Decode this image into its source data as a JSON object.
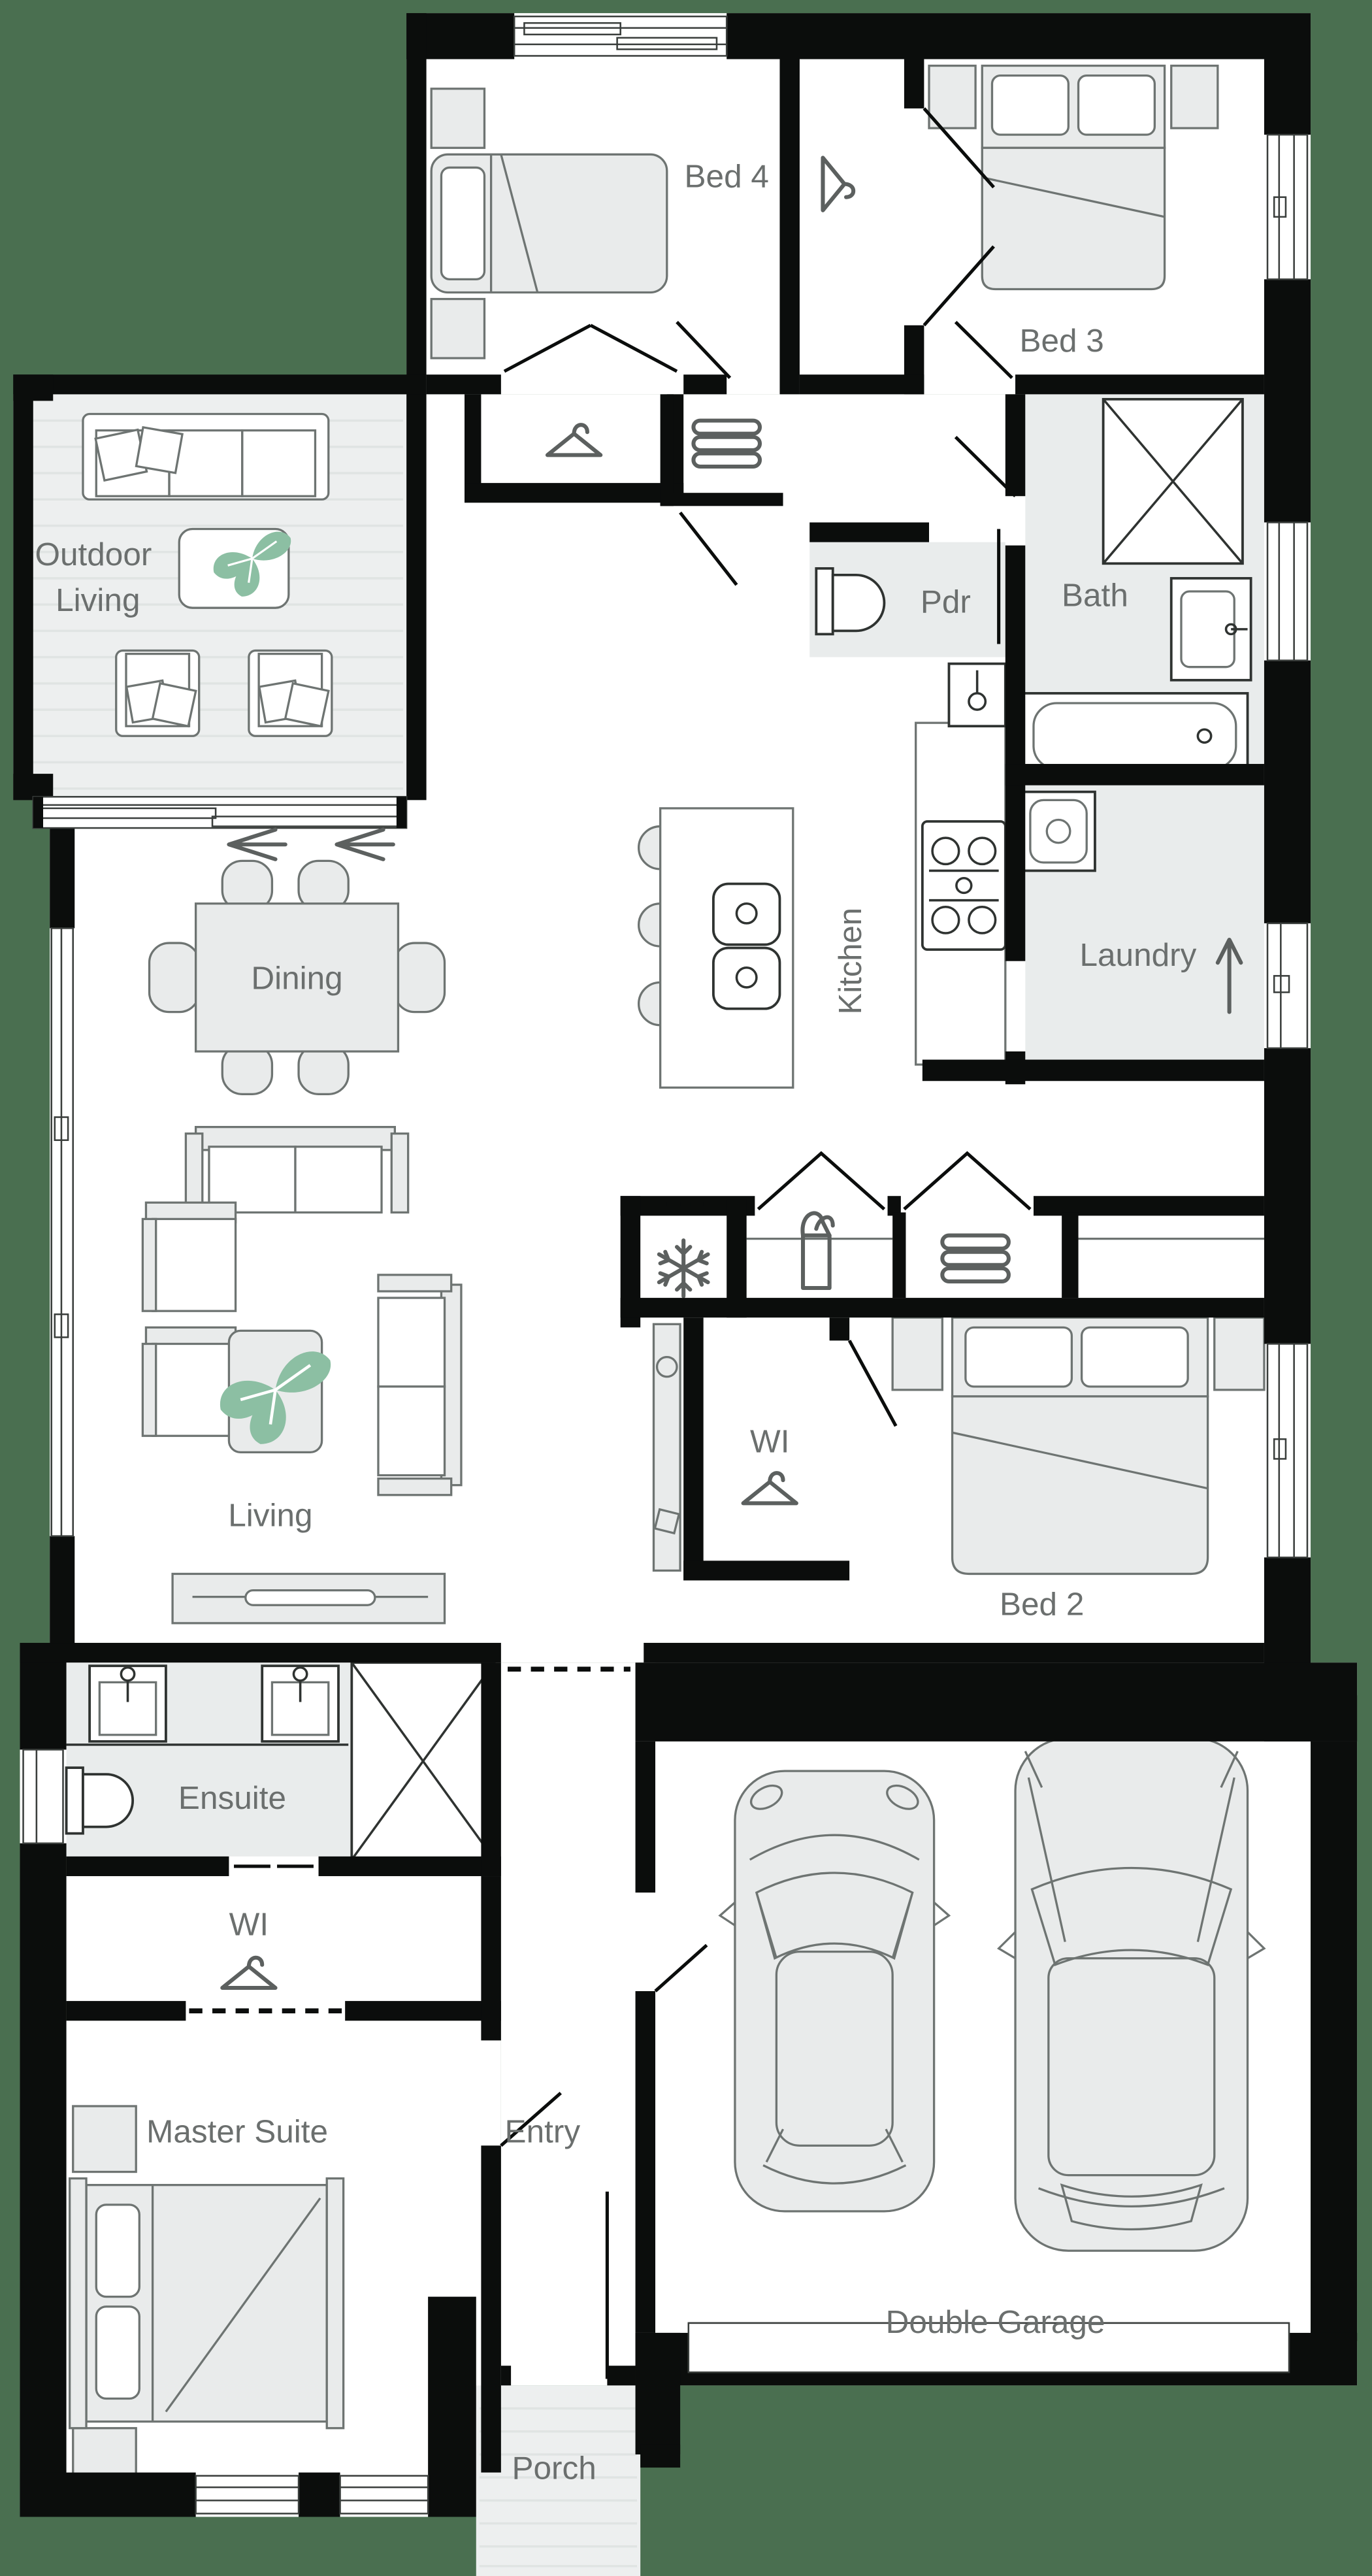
{
  "plan": {
    "colors": {
      "background": "#4a6f50",
      "wall": "#0b0d0c",
      "floor": "#ffffff",
      "wet_area": "#e9ecec",
      "furniture_fill": "#e9ebeb",
      "furniture_stroke": "#6e7472",
      "label_text": "#6b6f6e",
      "plant": "#8cbfa3"
    },
    "rooms": {
      "bed4": "Bed 4",
      "bed3": "Bed 3",
      "outdoor_line1": "Outdoor",
      "outdoor_line2": "Living",
      "pdr": "Pdr",
      "bath": "Bath",
      "dining": "Dining",
      "kitchen": "Kitchen",
      "laundry": "Laundry",
      "living": "Living",
      "wi_bed2": "WI",
      "bed2": "Bed 2",
      "ensuite": "Ensuite",
      "wi_master": "WI",
      "master": "Master Suite",
      "entry": "Entry",
      "garage": "Double Garage",
      "porch": "Porch"
    },
    "icons": [
      "hanger-icon",
      "hook-hanger-icon",
      "snowflake-fridge-icon",
      "towel-stack-icon",
      "pantry-goods-icon",
      "plant-icon",
      "sliding-door-arrow-icon",
      "laundry-exit-arrow-icon"
    ]
  }
}
